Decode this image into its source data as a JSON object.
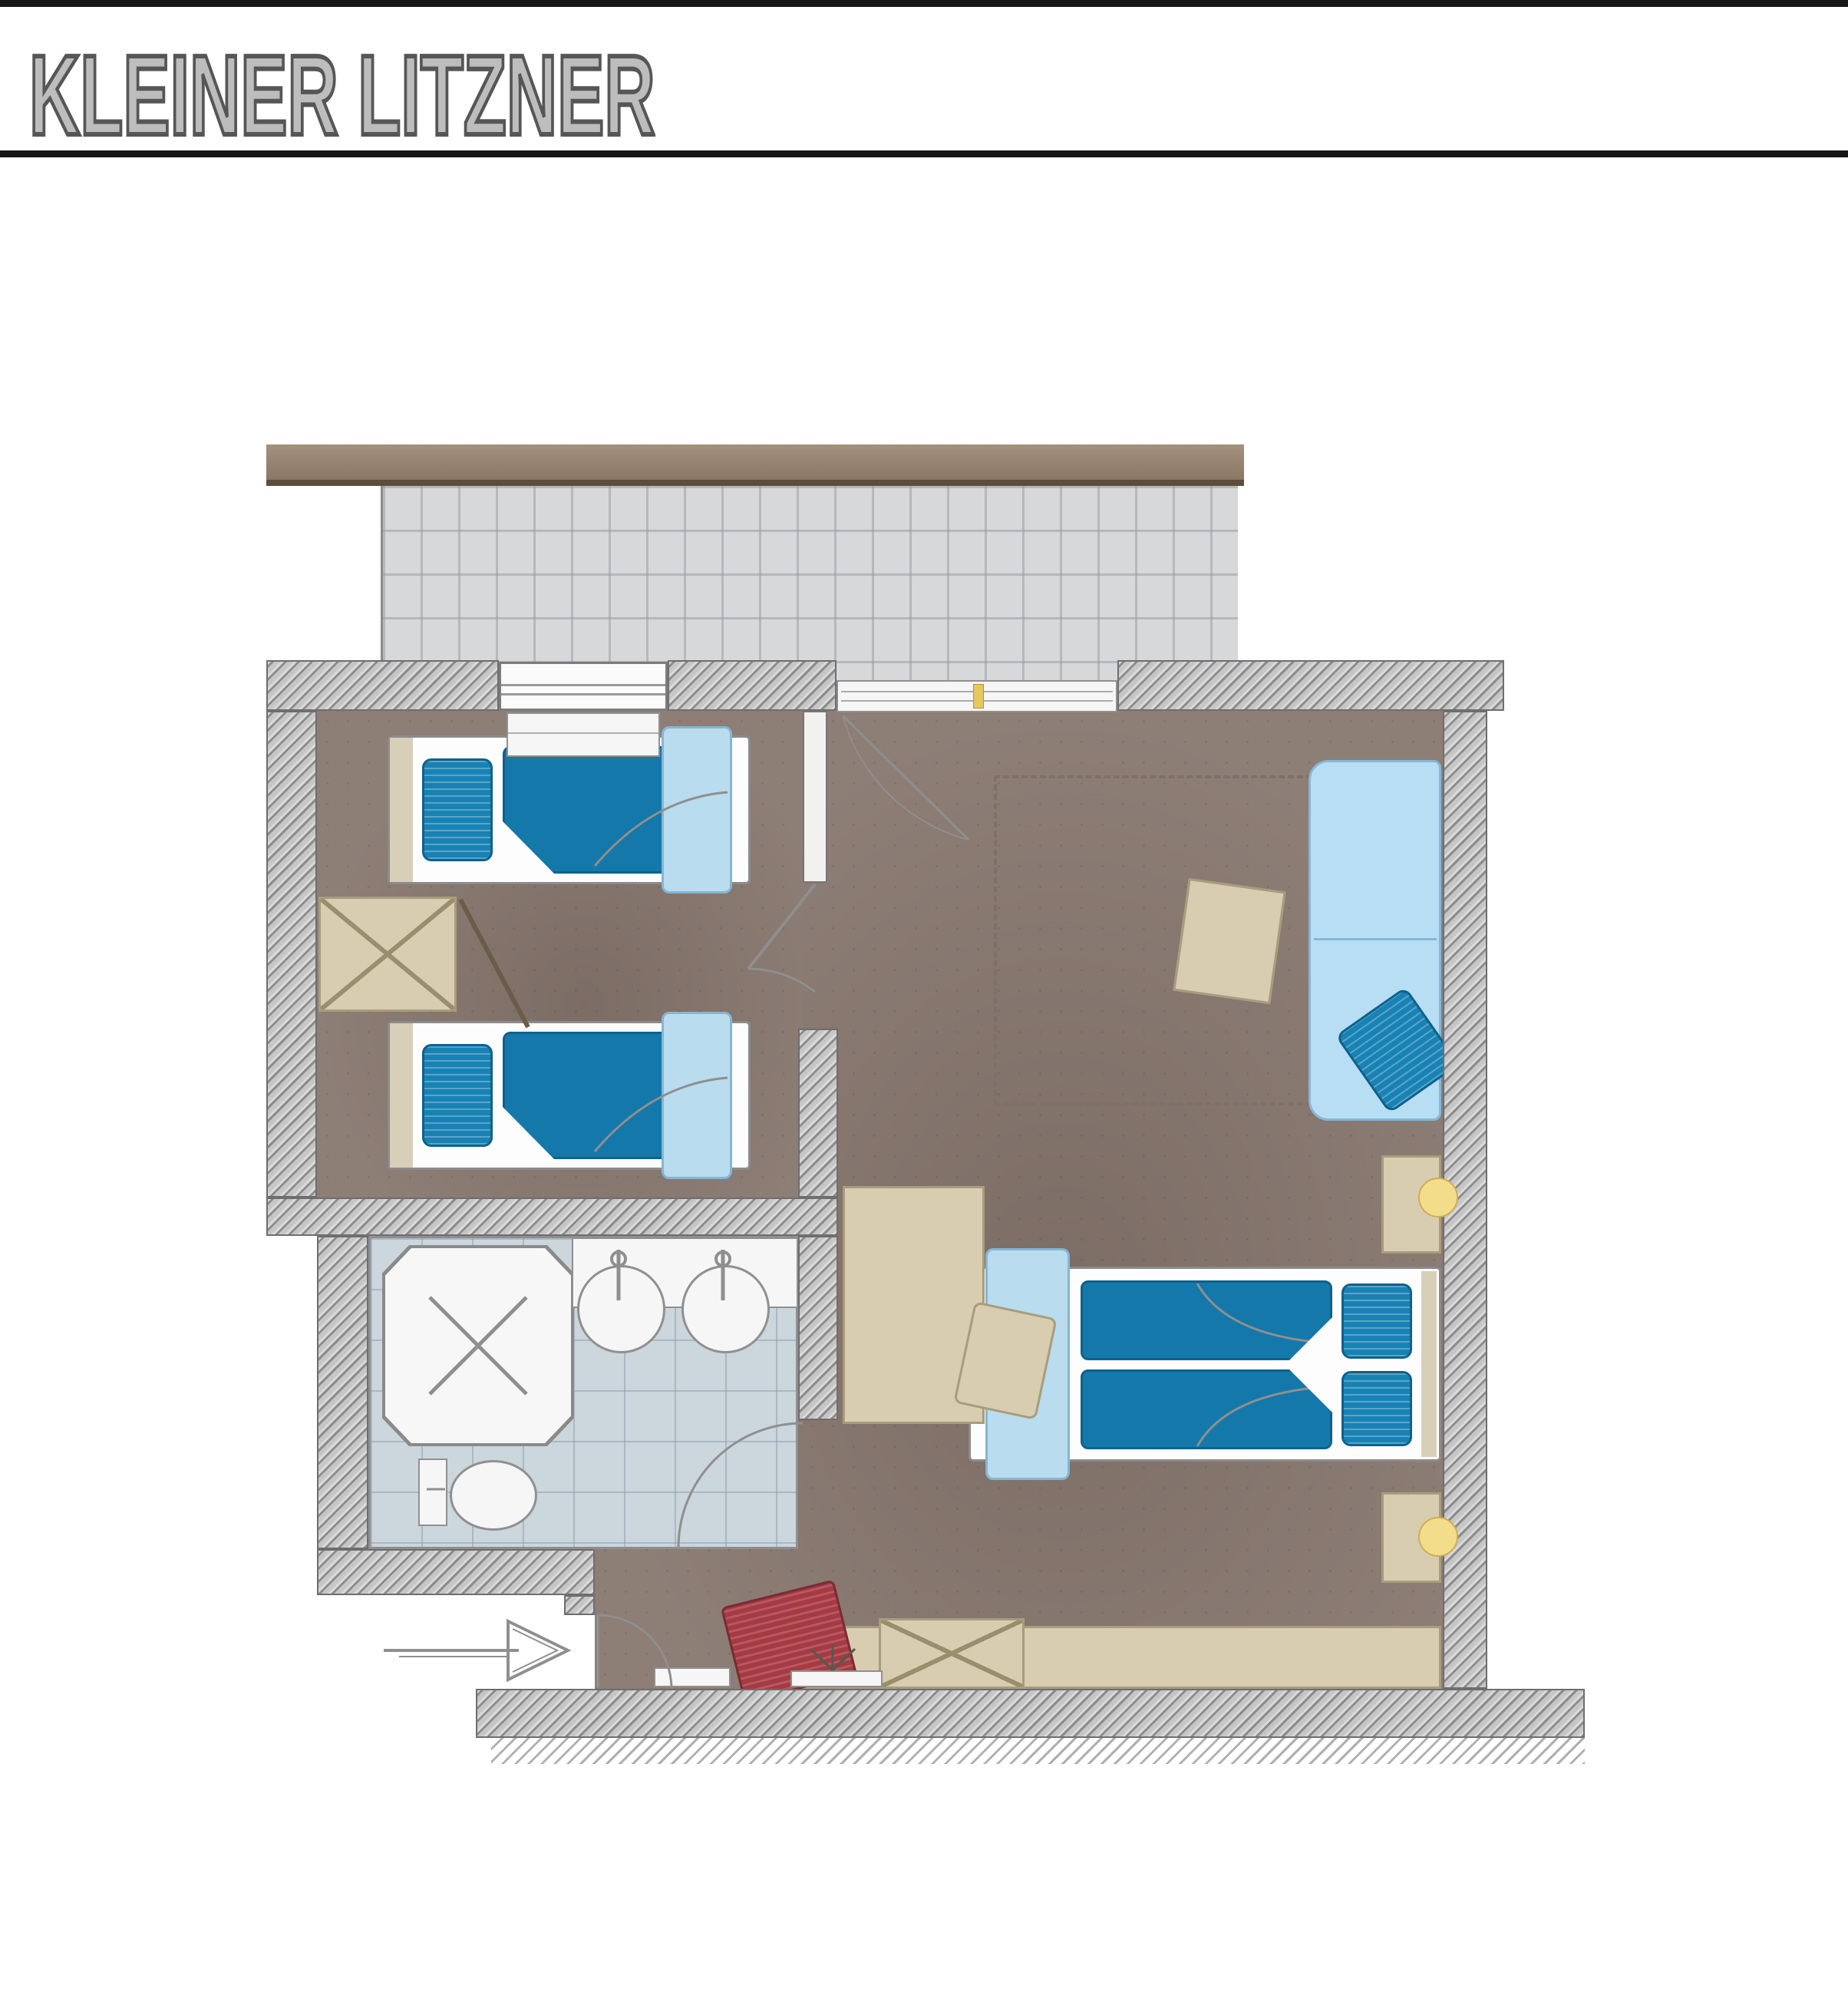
{
  "header": {
    "title": "KLEINER LITZNER",
    "title_fill": "#bdbdbd",
    "title_outline": "#565656",
    "rule_color": "#161616"
  },
  "plan": {
    "rooms": [
      {
        "name": "balcony"
      },
      {
        "name": "children-bedroom"
      },
      {
        "name": "bathroom"
      },
      {
        "name": "main-bedroom"
      },
      {
        "name": "entry-hall"
      }
    ],
    "furniture": [
      {
        "name": "single-bed",
        "count": 2
      },
      {
        "name": "wardrobe-x",
        "count": 2
      },
      {
        "name": "sofa-daybed",
        "count": 1
      },
      {
        "name": "ottoman-table",
        "count": 1
      },
      {
        "name": "double-bed",
        "count": 1
      },
      {
        "name": "nightstand-with-lamp",
        "count": 2
      },
      {
        "name": "desk",
        "count": 1
      },
      {
        "name": "desk-chair",
        "count": 1
      },
      {
        "name": "shower",
        "count": 1
      },
      {
        "name": "washbasin",
        "count": 2
      },
      {
        "name": "toilet",
        "count": 1
      },
      {
        "name": "sideboard",
        "count": 1
      },
      {
        "name": "red-armchair",
        "count": 1
      },
      {
        "name": "doormat",
        "count": 1
      },
      {
        "name": "plant",
        "count": 1
      }
    ],
    "colors": {
      "wall_hatch": "#c6c6c6",
      "floor_brown": "#8d7e76",
      "balcony_gray": "#d7d8da",
      "tile_blue_gray": "#ccd6dd",
      "bedding_blue": "#1478aa",
      "throw_light_blue": "#b9dcee",
      "sofa_light_blue": "#b7def2",
      "furniture_beige": "#d8cdb0",
      "armchair_red": "#a63a42",
      "lamp_yellow": "#f3dd8b",
      "roof_brown": "#8a7765"
    }
  }
}
